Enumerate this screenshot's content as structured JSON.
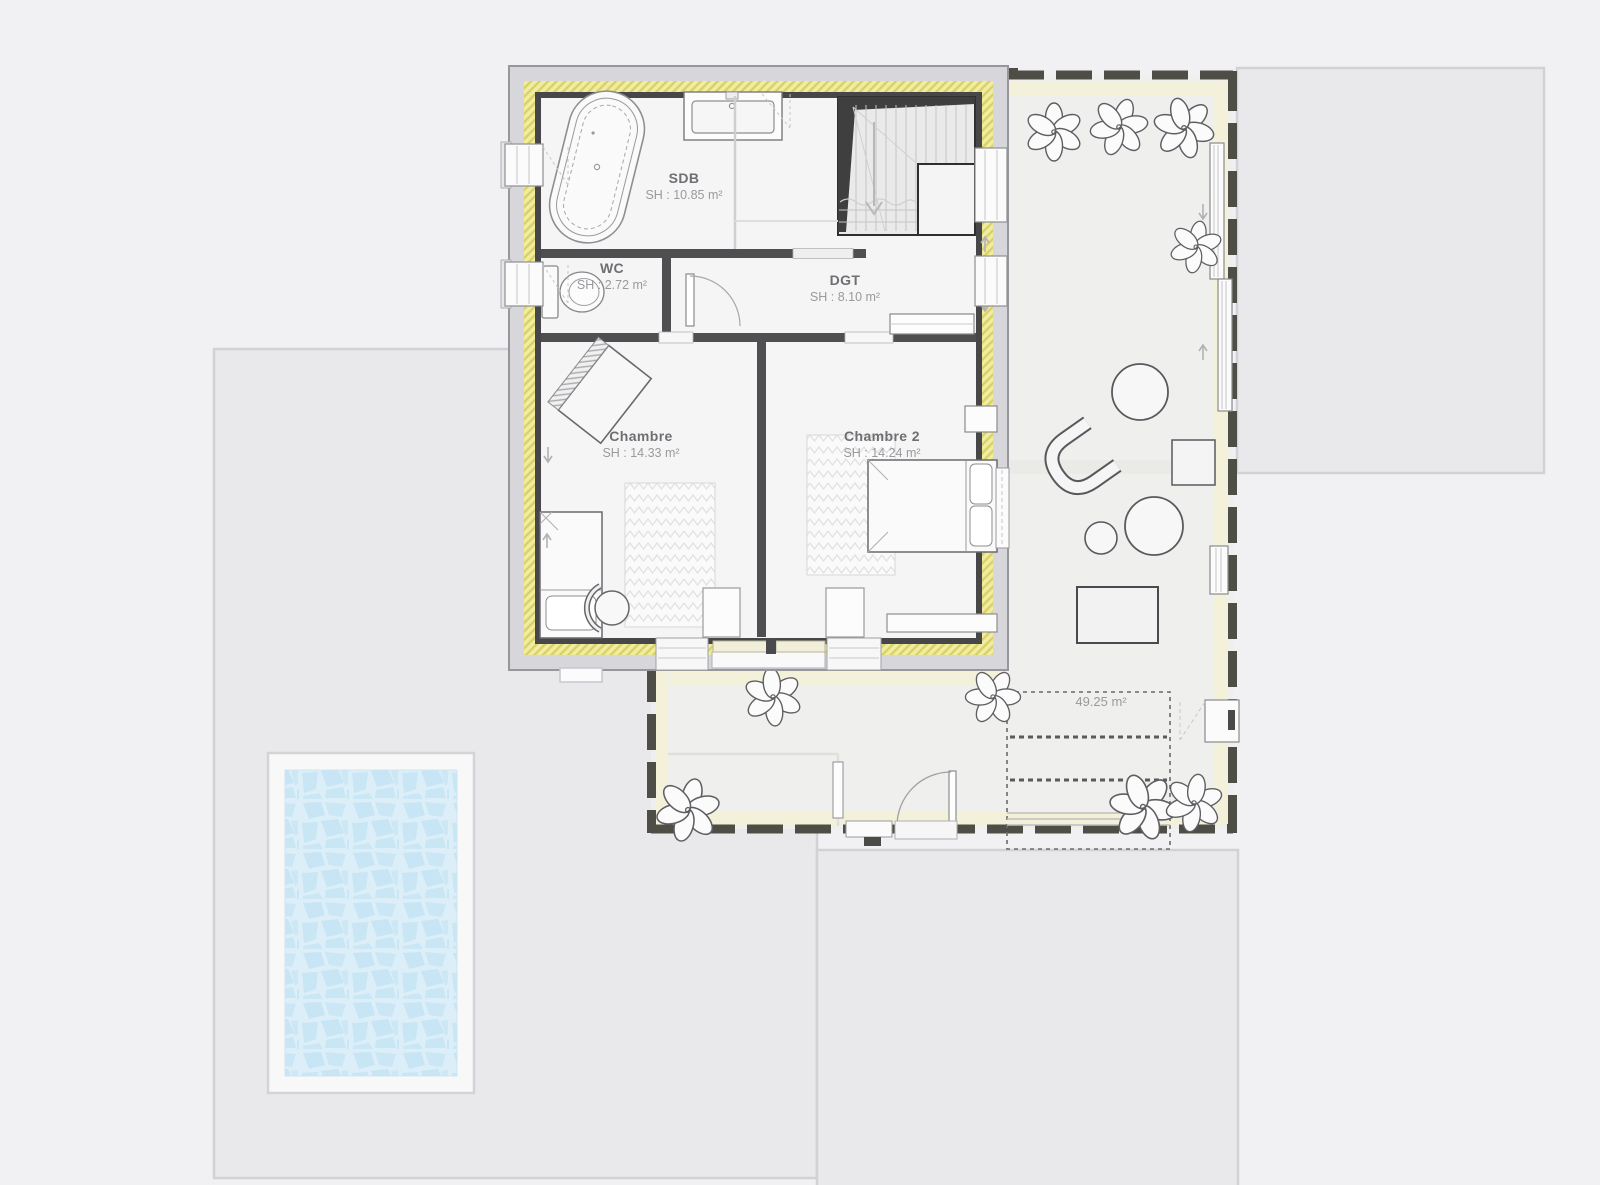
{
  "page": {
    "background_color": "#f1f1f3"
  },
  "plan": {
    "rooms": [
      {
        "id": "sdb",
        "name": "SDB",
        "area_label": "SH : 10.85 m²"
      },
      {
        "id": "wc",
        "name": "WC",
        "area_label": "SH : 2.72 m²"
      },
      {
        "id": "dgt",
        "name": "DGT",
        "area_label": "SH : 8.10 m²"
      },
      {
        "id": "chambre",
        "name": "Chambre",
        "area_label": "SH : 14.33 m²"
      },
      {
        "id": "chambre2",
        "name": "Chambre 2",
        "area_label": "SH : 14.24 m²"
      }
    ],
    "terrace_area_label": "49.25 m²",
    "colors": {
      "background": "#f1f1f3",
      "ground_block": "#e9e9eb",
      "wall_outer_band": "#d7d7db",
      "wall_insulation": "#ece88f",
      "wall_inner_line": "#47474a",
      "interior_floor": "#f5f5f5",
      "partition_wall": "#4f4f52",
      "terrace_floor": "#efefee",
      "terrace_band": "#f4f1db",
      "terrace_wall": "#4e4e46",
      "pool_water": "#cde9f6",
      "pool_grout": "#dceff9",
      "room_name_text": "#6f6f73",
      "room_area_text": "#9a9a9e"
    }
  }
}
